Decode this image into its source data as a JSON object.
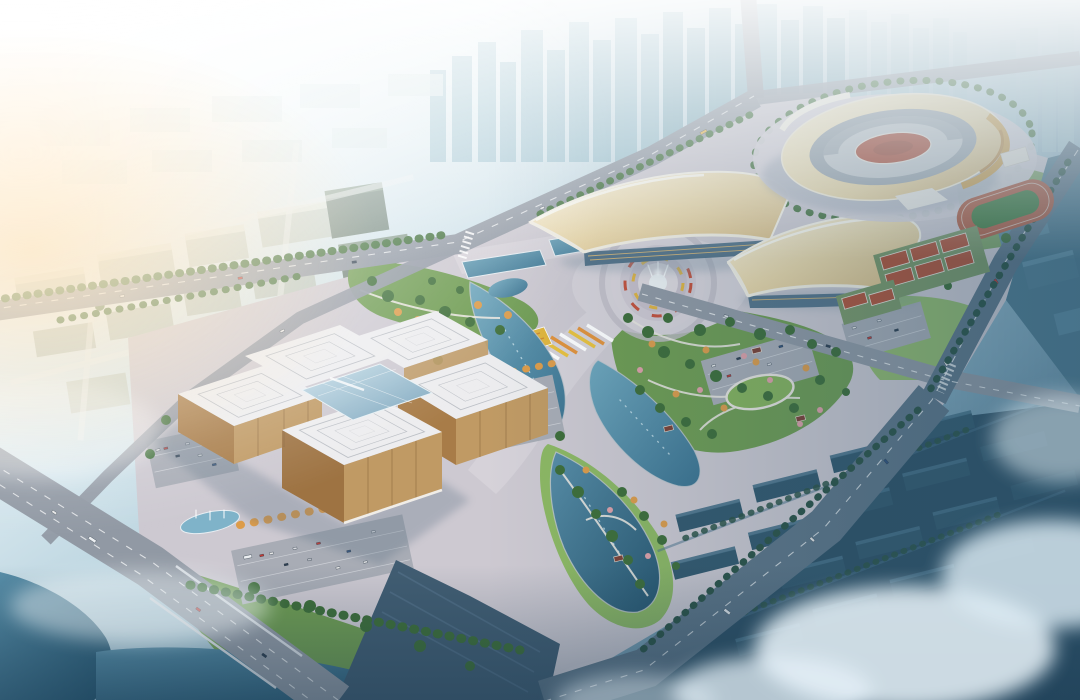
{
  "meta": {
    "title": "Aerial rendering of a civic sports and culture complex at dusk"
  },
  "scene": {
    "landmarks": [
      {
        "id": "city-skyline",
        "label": "hazy high-rise skyline"
      },
      {
        "id": "office-district",
        "label": "low-rise office blocks (west)"
      },
      {
        "id": "stadium",
        "label": "elliptical main stadium with gold facade"
      },
      {
        "id": "exhibition-hall-west",
        "label": "saddle-roof exhibition hall (west)"
      },
      {
        "id": "exhibition-hall-east",
        "label": "saddle-roof exhibition hall (east)"
      },
      {
        "id": "culture-center",
        "label": "culture center with concentric-square roofs and glass atrium"
      },
      {
        "id": "fountain-plaza",
        "label": "circular fountain plaza"
      },
      {
        "id": "flower-promenade",
        "label": "striped flower promenade with arc gateway"
      },
      {
        "id": "crescent-lakes",
        "label": "crescent-shaped park lakes"
      },
      {
        "id": "running-track",
        "label": "athletics training track"
      },
      {
        "id": "tennis-courts",
        "label": "red outdoor courts"
      },
      {
        "id": "parking-lots",
        "label": "surface parking lots with cars"
      },
      {
        "id": "river-bridge",
        "label": "riverside boulevard and bridge (southwest)"
      },
      {
        "id": "southeast-boulevard",
        "label": "wide tree-lined boulevard (southeast)"
      },
      {
        "id": "fog-district",
        "label": "foggy dark residential district (bottom right)"
      }
    ]
  },
  "palette": {
    "sky_top": "#f2fafc",
    "haze": "#ffffff",
    "sun_warm": "#ffe3bd",
    "city_far": "#aed0da",
    "towers": "#8fb8c6",
    "city_left": "#c3cfc9",
    "teal_mid": "#517b90",
    "dark_block": "#33586d",
    "road": "#9199a4",
    "road_dark": "#5e7587",
    "plaza": "#cdc9d1",
    "park_green": "#6f9c52",
    "park_light": "#8db863",
    "tree_green": "#3e6e39",
    "tree_autumn": "#dd9c4a",
    "tree_pink": "#dfa0a8",
    "water": "#4f86a0",
    "water_dark": "#2e5e7c",
    "roof_white": "#ededef",
    "roof_gold": "#e8d2a0",
    "facade_tan": "#c09a64",
    "glass_blue": "#9dc0d2",
    "court_red": "#b2543a",
    "track_green": "#3e7a3c",
    "lot": "#a8acb5",
    "fountain": "#ffffff"
  }
}
